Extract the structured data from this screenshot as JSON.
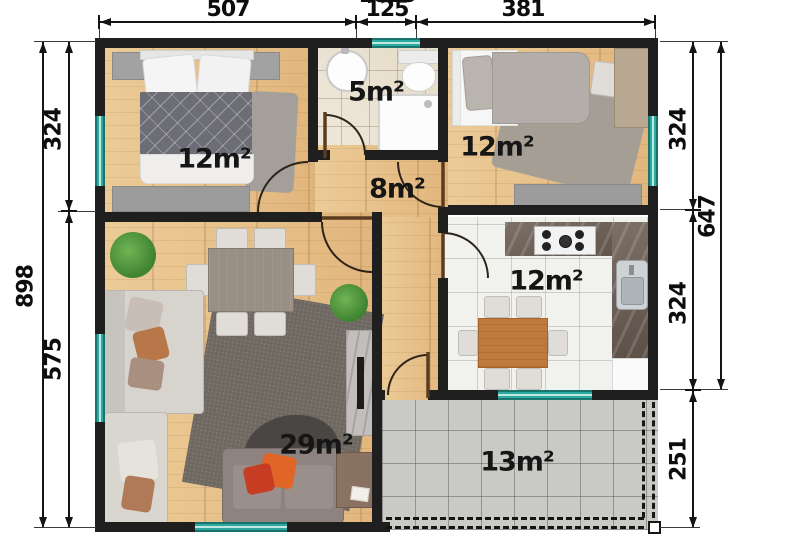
{
  "rooms": [
    {
      "id": "bedroom-1",
      "area_label": "12m²"
    },
    {
      "id": "bathroom",
      "area_label": "5m²"
    },
    {
      "id": "bedroom-2",
      "area_label": "12m²"
    },
    {
      "id": "hallway",
      "area_label": "8m²"
    },
    {
      "id": "kitchen",
      "area_label": "12m²"
    },
    {
      "id": "living-room",
      "area_label": "29m²"
    },
    {
      "id": "terrace",
      "area_label": "13m²"
    }
  ],
  "dimensions": {
    "top": [
      "507",
      "125",
      "381"
    ],
    "top_total_partial": "1013",
    "left_outer": "898",
    "left_inner": [
      "324",
      "575"
    ],
    "right_inner": [
      "324",
      "324",
      "251"
    ],
    "right_outer": "647"
  },
  "colors": {
    "wall": "#1f1f1f",
    "window_teal": "#2fa89f",
    "wood_floor": "#e9c392",
    "bath_tile": "#ebe3d4",
    "kitchen_tile": "#f1f1ee",
    "terrace_tile": "#c9c9c6",
    "dimension_text": "#0d0d0d"
  }
}
